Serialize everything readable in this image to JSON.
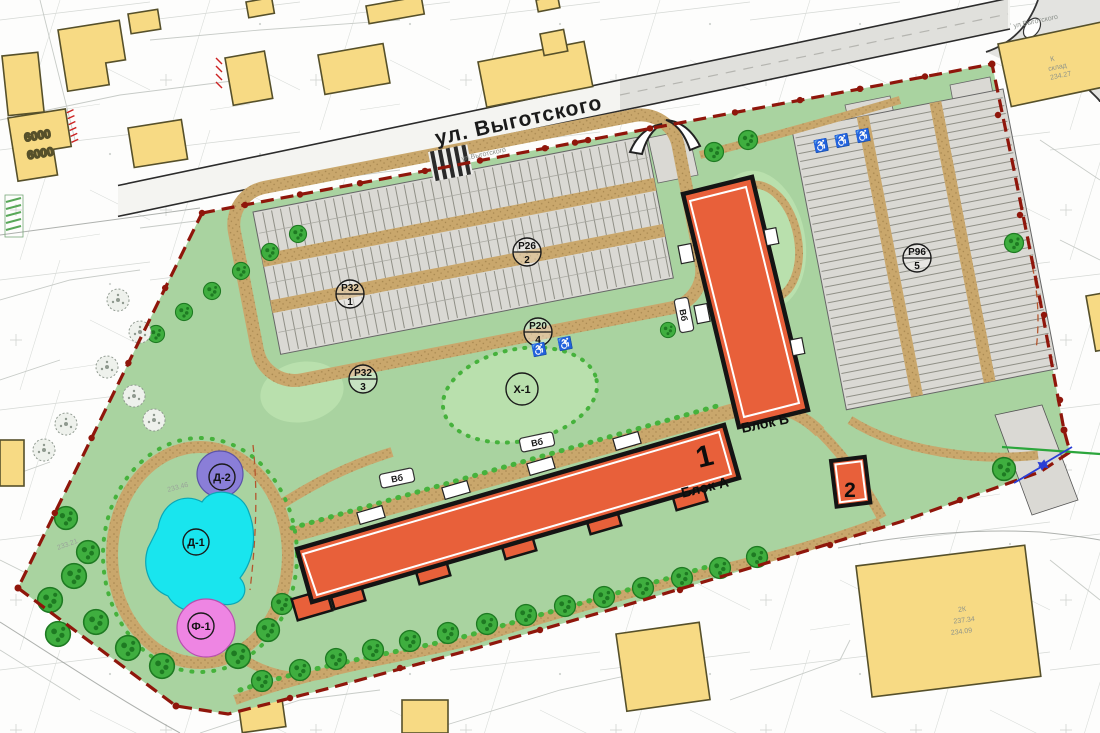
{
  "plan": {
    "street": {
      "name": "ул. Выготского",
      "name_small": "ул.Выготского"
    },
    "new_buildings": {
      "block_a_number": "1",
      "block_a_label": "Блок А",
      "block_b_label": "Блок Б",
      "substation_number": "2"
    },
    "parking": [
      {
        "code": "Р32",
        "index": "1"
      },
      {
        "code": "Р26",
        "index": "2"
      },
      {
        "code": "Р32",
        "index": "3"
      },
      {
        "code": "Р20",
        "index": "4"
      },
      {
        "code": "Р96",
        "index": "5"
      }
    ],
    "playgrounds": {
      "d1": "Д-1",
      "d2": "Д-2",
      "f1": "Ф-1",
      "x1": "Х-1"
    },
    "bike_parking_label": "Вб",
    "existing_buildings": {
      "dim_width": "6000",
      "dim_height": "6000",
      "warehouse_storeys": "К",
      "warehouse_label": "склад",
      "warehouse_elevation": "234.27",
      "house_storeys": "2К",
      "house_elevation": "237.34",
      "house_basement_elevation": "234.09"
    },
    "survey_marks": {
      "m1": "233.21",
      "m2": "233.46"
    },
    "icons": {
      "disabled_parking_glyph": "♿"
    },
    "colors": {
      "site_green": "#a9d3a0",
      "lawn_green": "#b9e0ad",
      "path_tan": "#c9a76c",
      "parking_gray": "#dad9d4",
      "new_building_orange": "#e8603a",
      "existing_building_yellow": "#f7da84",
      "boundary_red": "#8f160b",
      "playground_purple": "#8a7ed8",
      "playground_cyan": "#19e5ee",
      "playground_pink": "#ee85e3",
      "tree_green": "#3fae3f"
    }
  }
}
